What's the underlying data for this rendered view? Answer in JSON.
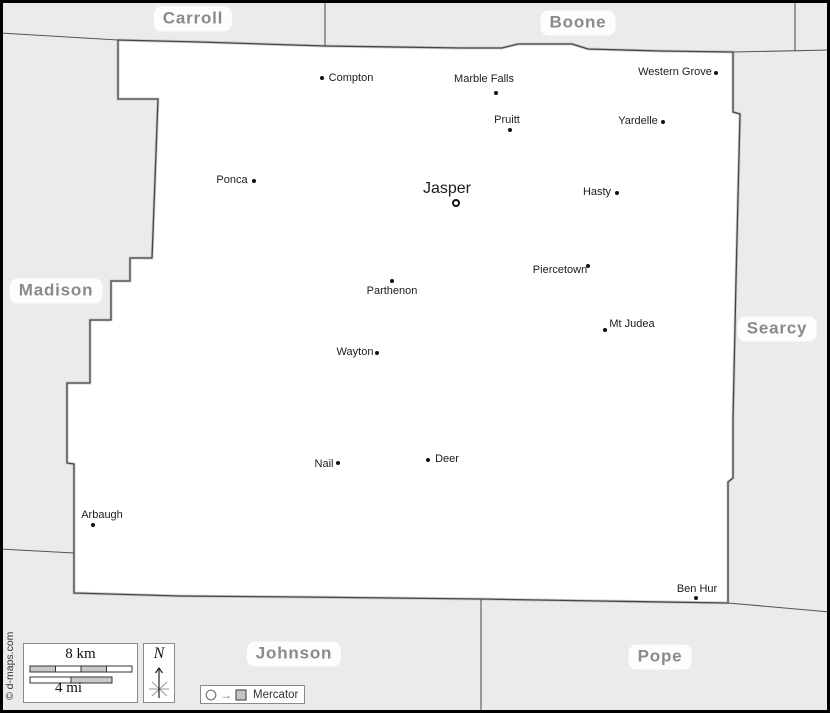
{
  "map_title": "Newton county map with neighboring counties",
  "colors": {
    "background": "#ebebeb",
    "land": "#ffffff",
    "boundary": "#4a4a4a",
    "county_label": "#8a8a8a",
    "town_label": "#1c1c1c",
    "frame": "#000000",
    "scale_segment_gray": "#c9c9c9"
  },
  "legend": {
    "projection": "Mercator",
    "scale_km": "8 km",
    "scale_mi": "4 mi",
    "north": "N",
    "copyright": "© d-maps.com"
  },
  "neighbor_counties": [
    {
      "name": "Carroll",
      "x": 193,
      "y": 19
    },
    {
      "name": "Boone",
      "x": 578,
      "y": 23
    },
    {
      "name": "Madison",
      "x": 56,
      "y": 291
    },
    {
      "name": "Searcy",
      "x": 777,
      "y": 329
    },
    {
      "name": "Johnson",
      "x": 294,
      "y": 654
    },
    {
      "name": "Pope",
      "x": 660,
      "y": 657
    }
  ],
  "towns": [
    {
      "name": "Compton",
      "x": 322,
      "y": 78,
      "lx": 351,
      "ly": 78,
      "seat": false
    },
    {
      "name": "Marble Falls",
      "x": 496,
      "y": 93,
      "lx": 484,
      "ly": 79,
      "seat": false
    },
    {
      "name": "Western Grove",
      "x": 716,
      "y": 73,
      "lx": 675,
      "ly": 72,
      "seat": false
    },
    {
      "name": "Pruitt",
      "x": 510,
      "y": 130,
      "lx": 507,
      "ly": 120,
      "seat": false
    },
    {
      "name": "Yardelle",
      "x": 663,
      "y": 122,
      "lx": 638,
      "ly": 121,
      "seat": false
    },
    {
      "name": "Ponca",
      "x": 254,
      "y": 181,
      "lx": 232,
      "ly": 180,
      "seat": false
    },
    {
      "name": "Jasper",
      "x": 456,
      "y": 203,
      "lx": 447,
      "ly": 189,
      "seat": true
    },
    {
      "name": "Hasty",
      "x": 617,
      "y": 193,
      "lx": 597,
      "ly": 192,
      "seat": false
    },
    {
      "name": "Piercetown",
      "x": 588,
      "y": 266,
      "lx": 560,
      "ly": 270,
      "seat": false
    },
    {
      "name": "Parthenon",
      "x": 392,
      "y": 281,
      "lx": 392,
      "ly": 291,
      "seat": false
    },
    {
      "name": "Mt Judea",
      "x": 605,
      "y": 330,
      "lx": 632,
      "ly": 324,
      "seat": false
    },
    {
      "name": "Wayton",
      "x": 377,
      "y": 353,
      "lx": 355,
      "ly": 352,
      "seat": false
    },
    {
      "name": "Nail",
      "x": 338,
      "y": 463,
      "lx": 324,
      "ly": 464,
      "seat": false
    },
    {
      "name": "Deer",
      "x": 428,
      "y": 460,
      "lx": 447,
      "ly": 459,
      "seat": false
    },
    {
      "name": "Arbaugh",
      "x": 93,
      "y": 525,
      "lx": 102,
      "ly": 515,
      "seat": false
    },
    {
      "name": "Ben Hur",
      "x": 696,
      "y": 598,
      "lx": 697,
      "ly": 589,
      "seat": false
    }
  ]
}
